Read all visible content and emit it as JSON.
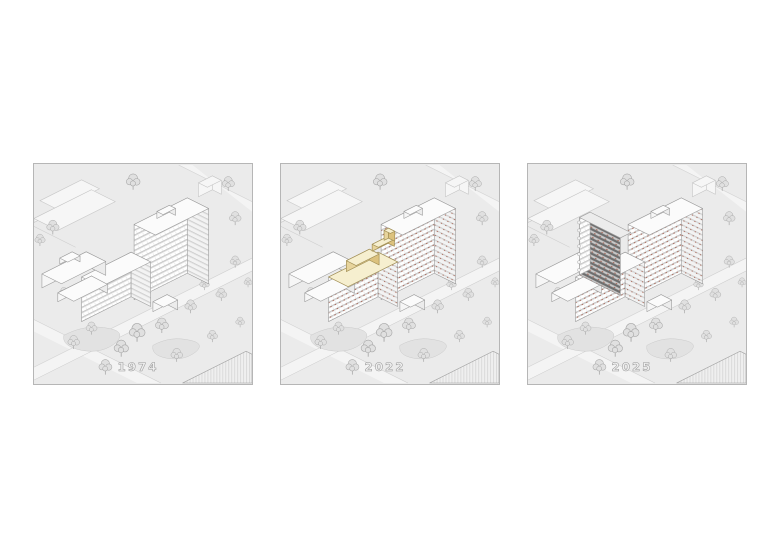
{
  "figure": {
    "type": "architectural-axonometric-sequence",
    "panels": [
      {
        "label": "1974",
        "highlighted_addition": "none"
      },
      {
        "label": "2022",
        "highlighted_addition": "rooftop-pavilions-yellow"
      },
      {
        "label": "2025",
        "highlighted_addition": "vertical-tower-extension-dark"
      }
    ]
  },
  "colors": {
    "page_bg": "#ffffff",
    "panel_bg": "#ebebeb",
    "panel_border": "#b6b6b6",
    "drawing_line": "#9c9c9c",
    "tree_fill": "#e0e0e0",
    "tree_line": "#a6a6a6",
    "highlight_roof": "#f6efcf",
    "highlight_wall": "#e7d49c",
    "highlight_wall_dark": "#dcc27e",
    "highlight_line": "#a28f55",
    "extension_band": "#6f6f6f",
    "extension_bg": "#c9c9c9",
    "accent_red": "#a2523e",
    "label_fill": "#f0f0f0",
    "label_line": "#9a9a9a",
    "road": "#f4f4f4",
    "lawn": "#e2e2e2"
  }
}
